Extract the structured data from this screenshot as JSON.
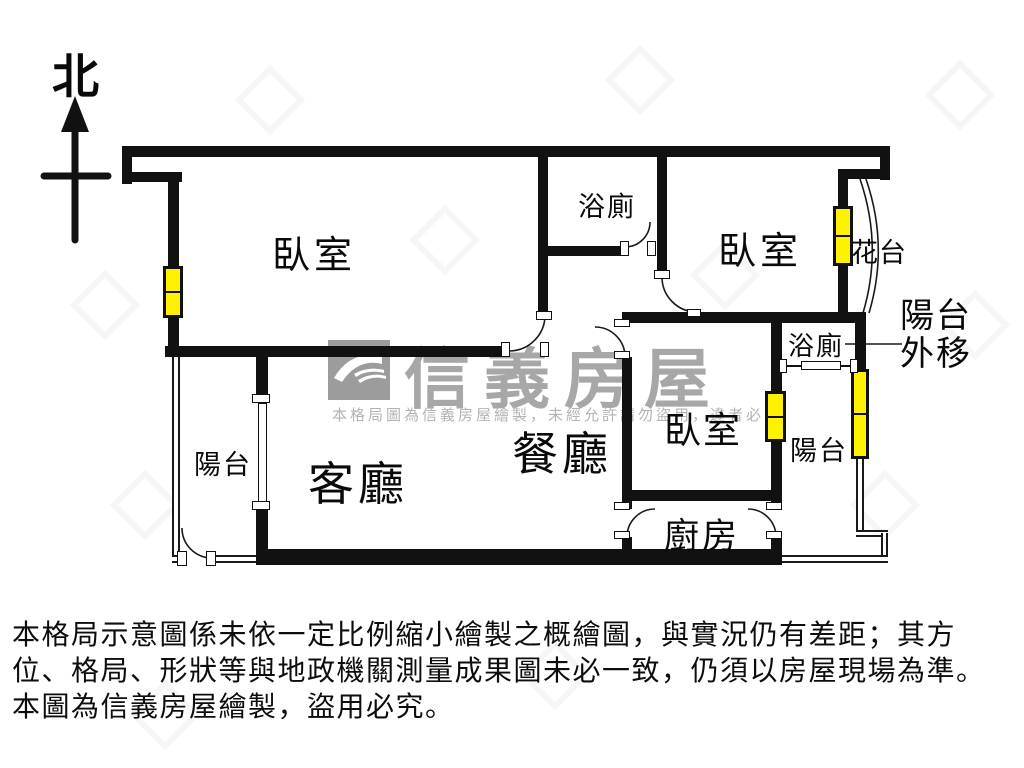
{
  "compass": {
    "label": "北"
  },
  "rooms": {
    "bedroom1": {
      "label": "臥室"
    },
    "bathroom1": {
      "label": "浴廁"
    },
    "bedroom2": {
      "label": "臥室"
    },
    "flower_stand": {
      "label": "花台"
    },
    "balcony_moved": {
      "line1": "陽台",
      "line2": "外移"
    },
    "bathroom2": {
      "label": "浴廁"
    },
    "bedroom3": {
      "label": "臥室"
    },
    "balcony_right": {
      "label": "陽台"
    },
    "balcony_left": {
      "label": "陽台"
    },
    "living_room": {
      "label": "客廳"
    },
    "dining_room": {
      "label": "餐廳"
    },
    "kitchen": {
      "label": "廚房"
    }
  },
  "watermark": {
    "brand": "信義房屋",
    "notice": "本格局圖為信義房屋繪製，未經允許請勿盜用，違者必究"
  },
  "disclaimer": {
    "line1": "本格局示意圖係未依一定比例縮小繪製之概繪圖，與實況仍有差距；其方",
    "line2": "位、格局、形狀等與地政機關測量成果圖未必一致，仍須以房屋現場為準。",
    "line3": "本圖為信義房屋繪製，盜用必究。"
  },
  "colors": {
    "wall": "#111111",
    "window": "#fff200",
    "watermark_gray": "#a7a7a7"
  }
}
